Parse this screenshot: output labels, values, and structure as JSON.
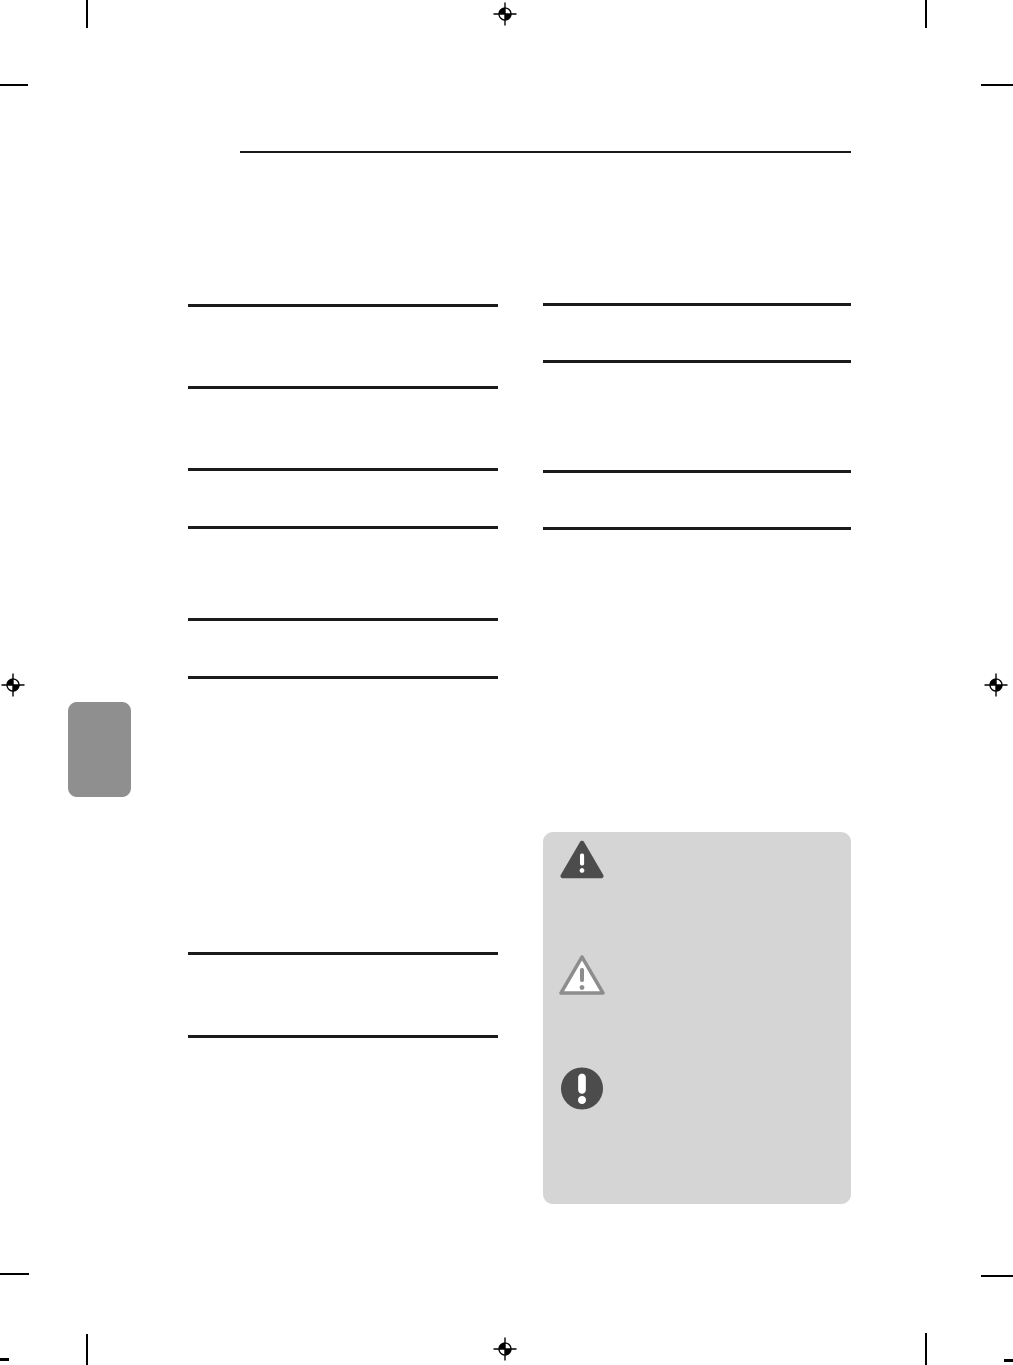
{
  "colors": {
    "page_background": "#ffffff",
    "content_rule": "#1b1b1b",
    "print_mark": "#000000",
    "section_tab": "#8f8f8f",
    "notice_box": "#d5d5d5",
    "icon_fill_dark": "#4c4c4c",
    "icon_outline": "#8d8d8d",
    "icon_glyph": "#ffffff"
  },
  "page": {
    "visible_text": "",
    "description": "printed manual page, text layer not rendered"
  },
  "rules": {
    "header_rule_count": 1,
    "left_column_rule_count": 8,
    "right_column_rule_count": 4
  },
  "print_marks": {
    "registration_marks": [
      "top-center",
      "left-edge",
      "right-edge",
      "bottom-center"
    ],
    "crop_marks": [
      "top-left-vertical",
      "top-right-vertical",
      "left-horizontal",
      "right-horizontal",
      "bottom-left-vertical",
      "bottom-right-vertical",
      "bottom-left-horizontal",
      "bottom-right-horizontal",
      "bottom-left-corner-tick",
      "bottom-right-corner-tick"
    ]
  },
  "section_tab": {
    "name": "chapter-thumb-tab"
  },
  "notice_box": {
    "icons": [
      {
        "name": "warning-triangle-filled-icon",
        "style": "filled dark triangle with white exclamation mark"
      },
      {
        "name": "warning-triangle-outline-icon",
        "style": "outlined triangle with gray exclamation mark"
      },
      {
        "name": "exclamation-circle-icon",
        "style": "filled dark circle with white exclamation mark"
      }
    ]
  }
}
